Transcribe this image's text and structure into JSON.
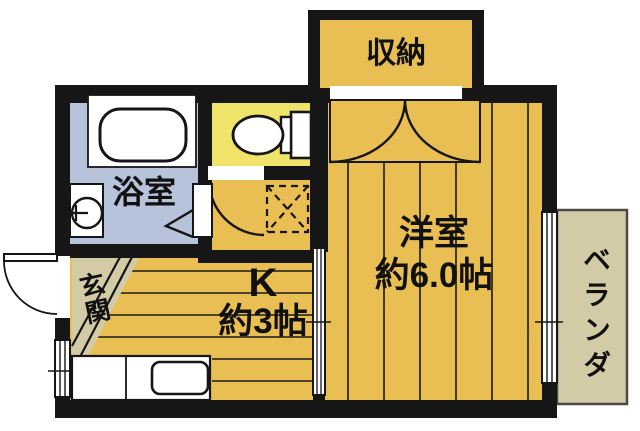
{
  "plan": {
    "type": "apartment-floor-plan",
    "labels": {
      "closet": "収納",
      "bathroom": "浴室",
      "entrance": "玄関",
      "kitchen_name": "K",
      "kitchen_size": "約3帖",
      "western_room_name": "洋室",
      "western_room_size": "約6.0帖",
      "balcony": "ベランダ"
    },
    "colors": {
      "wall": "#161616",
      "room_floor": "#E9BE52",
      "toilet_floor": "#EFE36A",
      "bath_floor": "#B6C3DB",
      "beige": "#D3CAA6",
      "balcony_floor": "#D3CAA6",
      "fixture": "#FFFFFF",
      "line": "#1A1A1A"
    }
  }
}
